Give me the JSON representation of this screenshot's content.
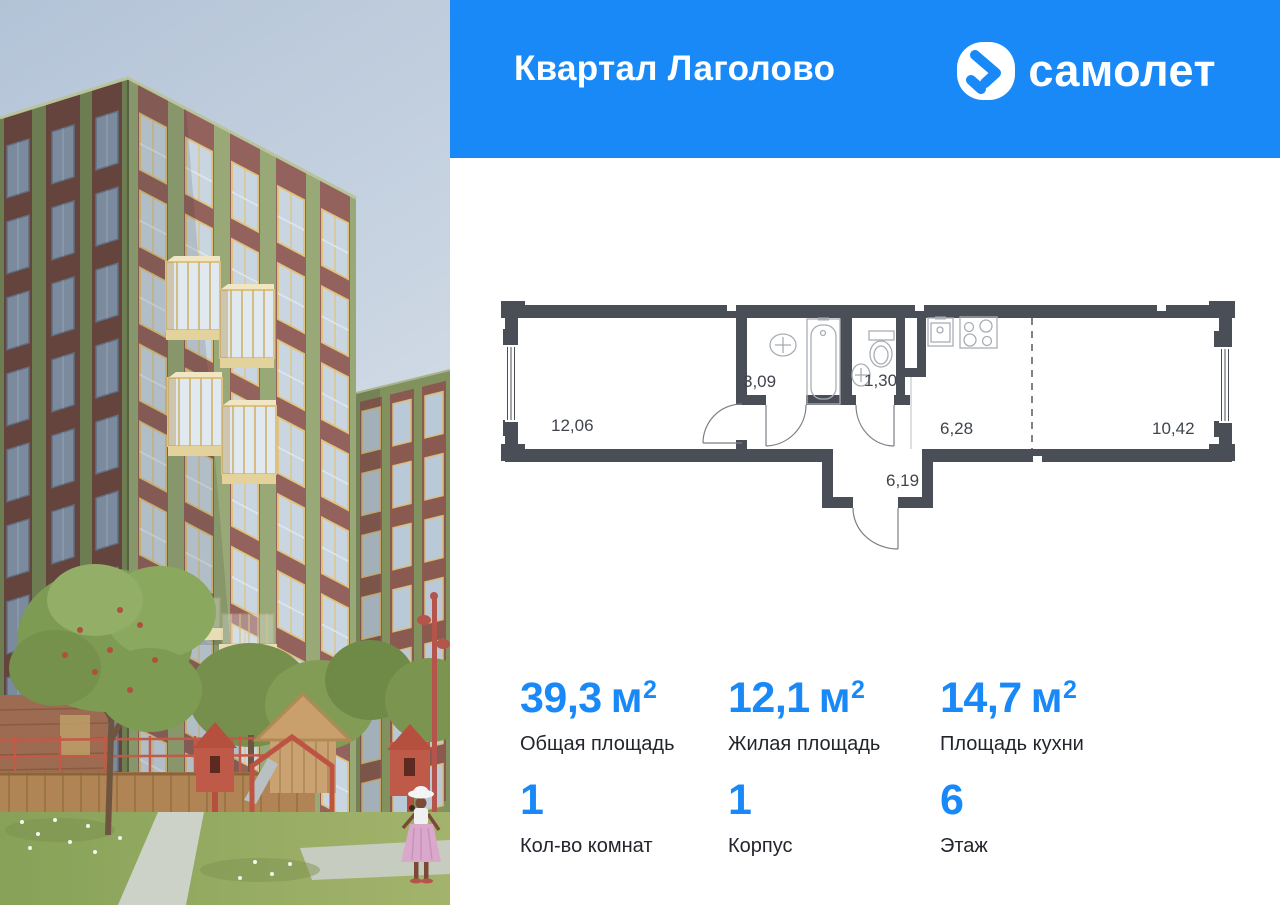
{
  "header": {
    "project_title": "Квартал Лаголово",
    "brand": "самолет",
    "logo_icon_name": "samolet-arrow-icon",
    "bg_color": "#1989f8"
  },
  "plan": {
    "wall_color": "#4a4e57",
    "rooms": [
      {
        "name": "living-room",
        "area": "12,06"
      },
      {
        "name": "bathroom",
        "area": "3,09"
      },
      {
        "name": "toilet",
        "area": "1,30"
      },
      {
        "name": "kitchen",
        "area": "6,28"
      },
      {
        "name": "room",
        "area": "10,42"
      },
      {
        "name": "hallway",
        "area": "6,19"
      }
    ]
  },
  "stats": {
    "accent_color": "#1989f8",
    "row1": [
      {
        "value": "39,3",
        "unit": "м",
        "sup": "2",
        "label": "Общая площадь"
      },
      {
        "value": "12,1",
        "unit": "м",
        "sup": "2",
        "label": "Жилая площадь"
      },
      {
        "value": "14,7",
        "unit": "м",
        "sup": "2",
        "label": "Площадь кухни"
      }
    ],
    "row2": [
      {
        "value": "1",
        "label": "Кол-во комнат"
      },
      {
        "value": "1",
        "label": "Корпус"
      },
      {
        "value": "6",
        "label": "Этаж"
      }
    ]
  }
}
